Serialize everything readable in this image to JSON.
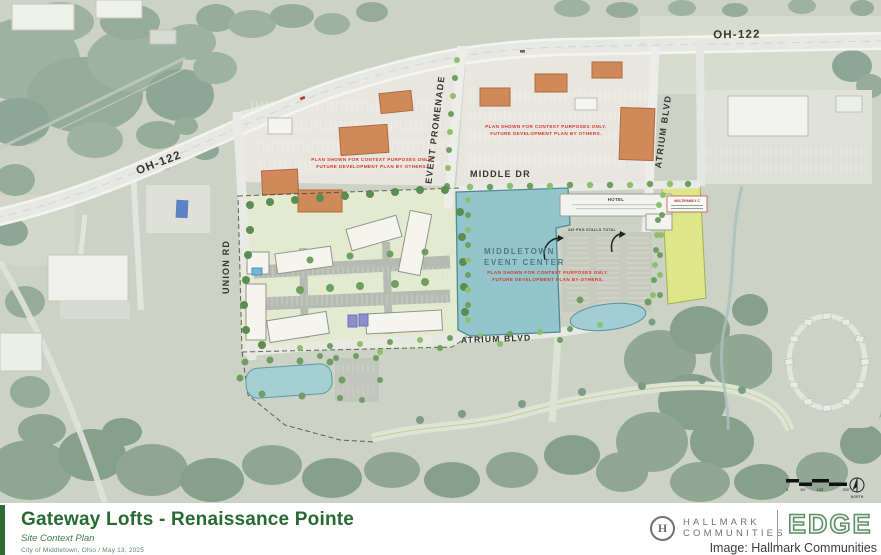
{
  "map": {
    "road_labels": {
      "oh122": "OH-122",
      "union": "UNION RD",
      "promenade": "EVENT PROMENADE",
      "middle": "MIDDLE DR",
      "atrium": "ATRIUM BLVD"
    },
    "disclaimer": {
      "line1": "PLAN SHOWN FOR CONTEXT PURPOSES ONLY.",
      "line2": "FUTURE DEVELOPMENT PLAN BY OTHERS."
    },
    "event_center": {
      "line1": "MIDDLETOWN",
      "line2": "EVENT CENTER"
    },
    "hotel_label": "HOTEL",
    "stalls_label": "330 PKG STALLS TOTAL",
    "multifamily_label": "MULTIFAMILY C",
    "scale": {
      "t0": "0",
      "t50": "50'",
      "t100": "100'",
      "t200": "200'",
      "north": "NORTH"
    }
  },
  "footer": {
    "title": "Gateway Lofts - Renaissance Pointe",
    "subtitle": "Site Context Plan",
    "meta": "City of Middletown, Ohio  /  May 13, 2025",
    "hallmark": {
      "monogram": "H",
      "line1": "HALLMARK",
      "line2": "COMMUNITIES"
    },
    "edge_logo": "EDGE"
  },
  "credit": "Image: Hallmark Communities",
  "colors": {
    "title_green": "#276b33",
    "disclaimer_red": "#d6372a",
    "event_center_teal": "#92c6cc",
    "retail_orange": "#d08a5a",
    "pond_teal": "#9fcdd3"
  }
}
